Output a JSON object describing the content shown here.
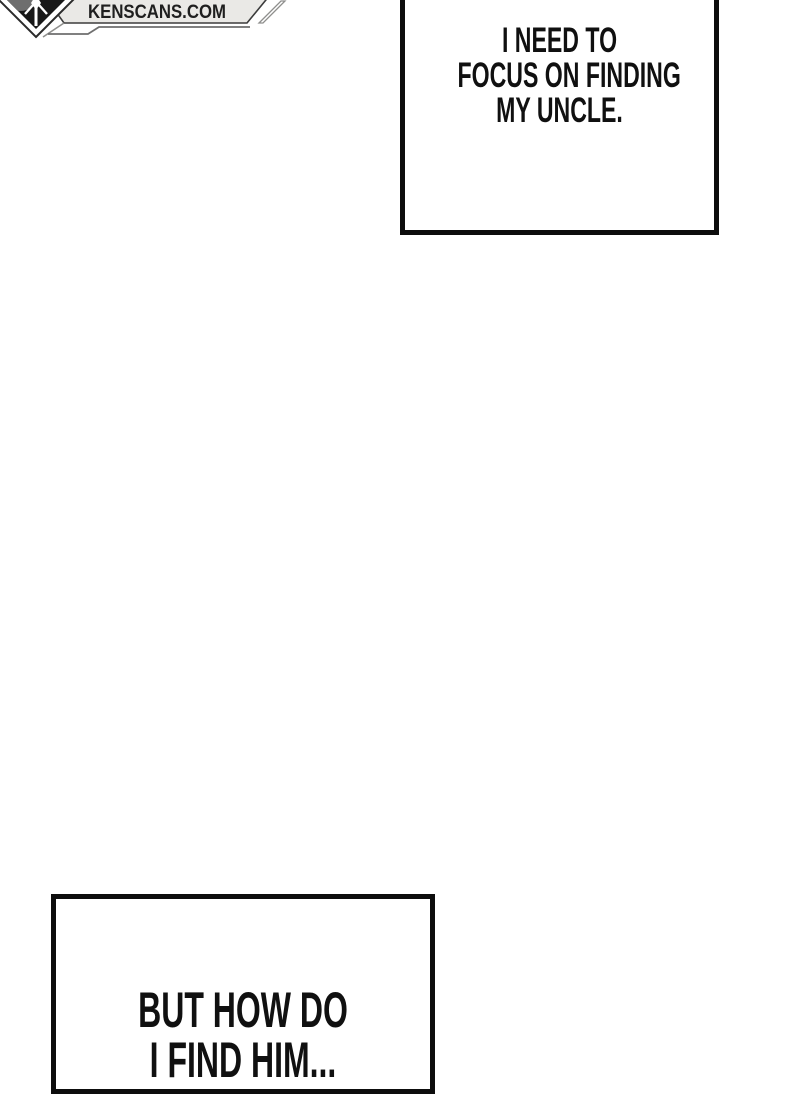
{
  "page": {
    "background_color": "#ffffff",
    "panel_border_color": "#0d0d0d",
    "text_color": "#101010"
  },
  "logo": {
    "site": "KENSCANS.COM",
    "banner_fill": "#eae9e6",
    "banner_border": "#3c3c3c",
    "banner_text_color": "#1f1f1f",
    "diamond_fill": "#181818",
    "diamond_band": "#ffffff",
    "moon_gray": "#6e6e6e",
    "accent_gray": "#8f8f8d",
    "emblem_icon": "sword-emblem-icon"
  },
  "speech_boxes": {
    "top": {
      "lines": [
        "I NEED TO",
        "FOCUS ON FINDING",
        "MY UNCLE."
      ]
    },
    "bottom": {
      "lines": [
        "BUT HOW DO",
        "I FIND HIM..."
      ]
    }
  }
}
